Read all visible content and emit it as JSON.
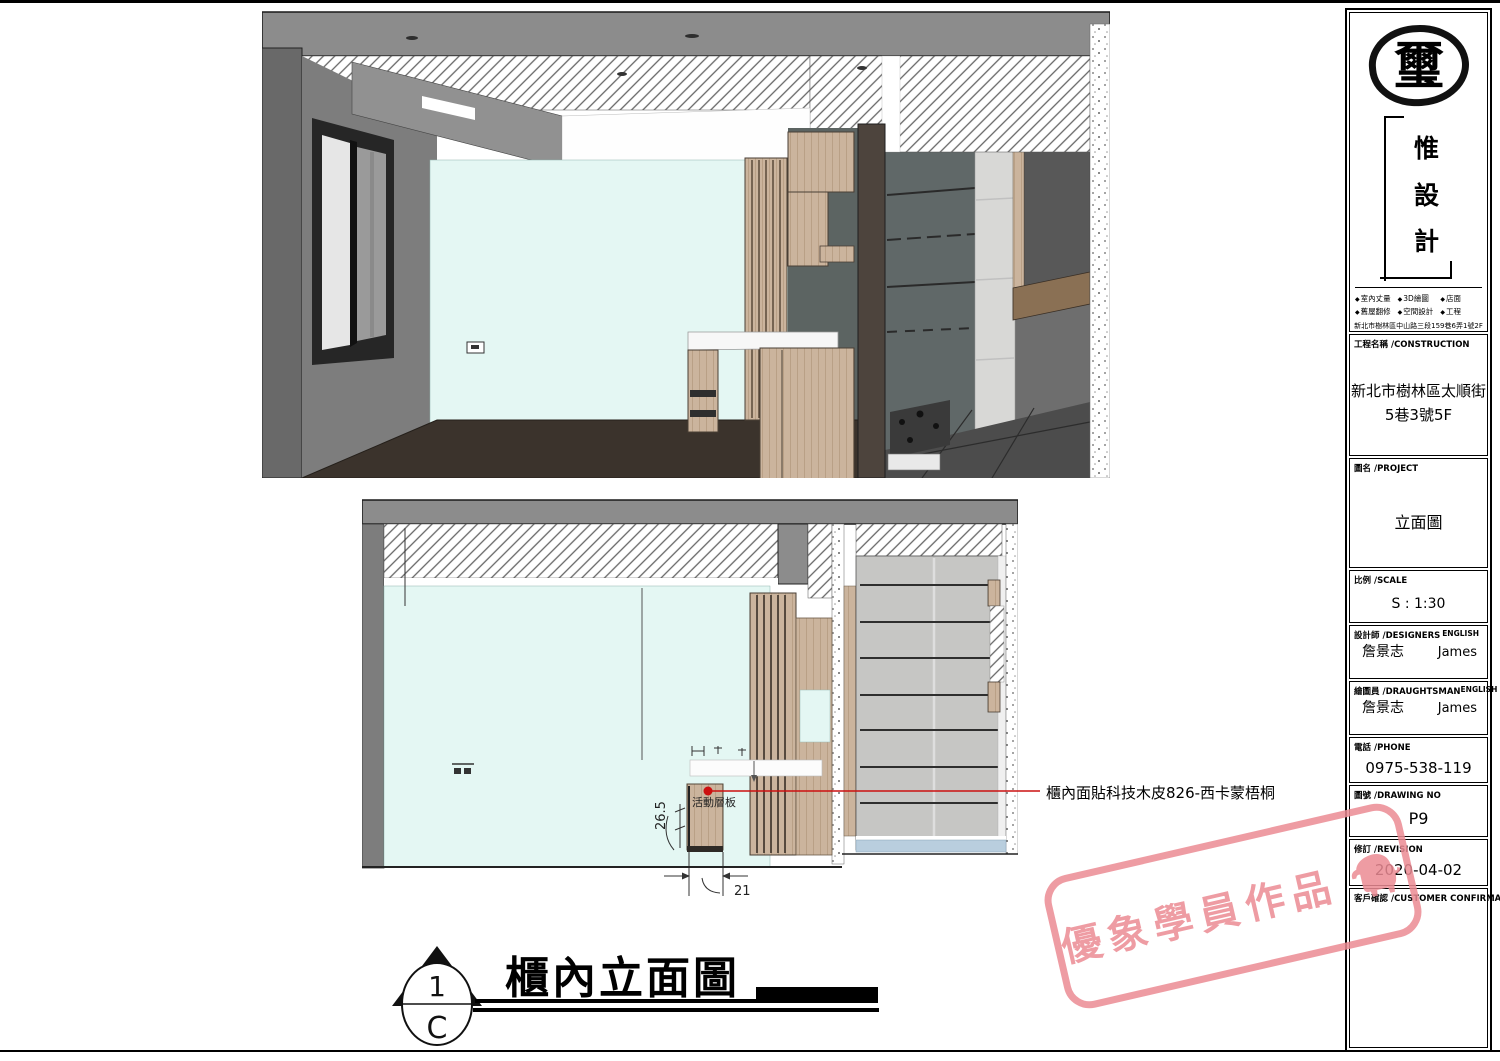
{
  "colors": {
    "accent_red": "#cc1010",
    "stamp_pink": "#ec8b94",
    "slab_gray": "#8c8c8c",
    "wall_gray": "#7b7b7b",
    "pale_wall": "#e4f7f3",
    "wood": "#cbb49d",
    "dark_wood": "#8a7054",
    "floor_brown": "#3b332c",
    "tile_gray": "#c6c6c4",
    "floor_blue": "#b9cede"
  },
  "title_block": {
    "logo_char": "璽",
    "brand_chars": [
      "惟",
      "設",
      "計"
    ],
    "services": [
      {
        "label": "室內丈量"
      },
      {
        "label": "3D繪圖"
      },
      {
        "label": "店面"
      },
      {
        "label": "舊屋翻修"
      },
      {
        "label": "空間設計"
      },
      {
        "label": "工程"
      }
    ],
    "address": "新北市樹林區中山路三段159巷6弄1號2F",
    "construction": {
      "label": "工程名稱 /CONSTRUCTION",
      "line1": "新北市樹林區太順街",
      "line2": "5巷3號5F"
    },
    "project": {
      "label": "圖名 /PROJECT",
      "value": "立面圖"
    },
    "scale": {
      "label": "比例 /SCALE",
      "value": "S : 1:30"
    },
    "designers": {
      "label": "設計師 /DESIGNERS",
      "english_label": "ENGLISH",
      "name": "詹景志",
      "english_name": "James"
    },
    "draughtsman": {
      "label": "繪圖員 /DRAUGHTSMAN",
      "english_label": "ENGLISH",
      "name": "詹景志",
      "english_name": "James"
    },
    "phone": {
      "label": "電話 /PHONE",
      "value": "0975-538-119"
    },
    "drawing_no": {
      "label": "圖號 /DRAWING NO",
      "value": "P9"
    },
    "revision": {
      "label": "修訂 /REVISION",
      "value": "2020-04-02"
    },
    "customer": {
      "label": "客戶確認 /CUSTOMER CONFIRMATION"
    }
  },
  "drawing": {
    "title": "櫃內立面圖",
    "detail_number": "1",
    "detail_sheet": "C",
    "annotation": "櫃內面貼科技木皮826-西卡蒙梧桐",
    "shelf_label": "活動層板",
    "dim_depth": "26.5",
    "dim_width": "21"
  },
  "stamp": {
    "text": "優象學員作品"
  }
}
